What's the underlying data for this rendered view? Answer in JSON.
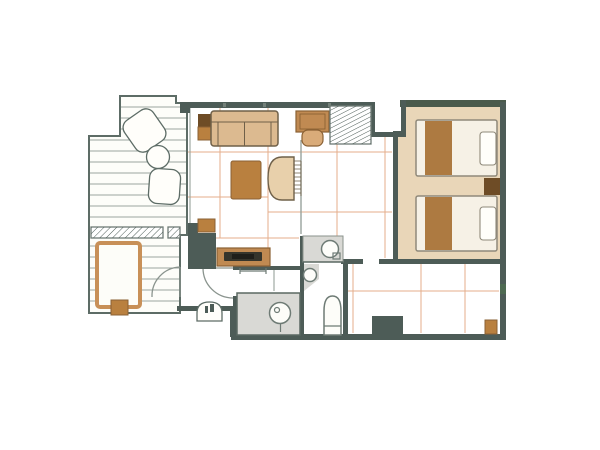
{
  "palette": {
    "wall": "#4d5c57",
    "wall_accent": "#4a5a4c",
    "outline": "#5d6c66",
    "fixture": "#6e7b75",
    "plank": "#9aa59f",
    "grid": "#dfa077",
    "floor_white": "#fdfdf9",
    "bedroom_floor": "#e9d6b8",
    "gray_floor": "#d9d9d5",
    "mattress": "#f6f1e6",
    "pillow": "#fffefa",
    "bed_runner": "#ad7a41",
    "bed_outline": "#8f897a",
    "wood_dark": "#6e4c26",
    "wood_medium": "#b9803f",
    "wood_light": "#d9ab79",
    "wood_line": "#8a6134",
    "sofa": "#dcba90",
    "lounge": "#e8d0ab",
    "desk_wood": "#c08a52",
    "furn_line": "#6f6049",
    "tub_rim": "#c89058",
    "door_arc": "#8a948e",
    "tatami_divider": "#98a29c",
    "shower_wall": "#5a6862",
    "door_mark": "#4e6a52",
    "tv_dark": "#35352c"
  },
  "rooms": [
    {
      "id": "terrace-deck"
    },
    {
      "id": "open-air-bath"
    },
    {
      "id": "living-room"
    },
    {
      "id": "bedroom"
    },
    {
      "id": "entrance-hall"
    },
    {
      "id": "washroom-anteroom"
    },
    {
      "id": "shower-room"
    },
    {
      "id": "washbasin-area"
    },
    {
      "id": "toilet-room"
    },
    {
      "id": "corridor"
    }
  ],
  "furniture": [
    {
      "id": "deck-chair-1"
    },
    {
      "id": "deck-chair-2"
    },
    {
      "id": "deck-round-table"
    },
    {
      "id": "deck-bench"
    },
    {
      "id": "bathtub"
    },
    {
      "id": "bathtub-step"
    },
    {
      "id": "sofa"
    },
    {
      "id": "sofa-side-table"
    },
    {
      "id": "coffee-table"
    },
    {
      "id": "lounge-chair"
    },
    {
      "id": "desk"
    },
    {
      "id": "desk-chair"
    },
    {
      "id": "luggage-rack"
    },
    {
      "id": "entrance-wardrobe"
    },
    {
      "id": "entrance-stool"
    },
    {
      "id": "tv-board"
    },
    {
      "id": "tv"
    },
    {
      "id": "bed-1"
    },
    {
      "id": "bed-2"
    },
    {
      "id": "nightstand"
    },
    {
      "id": "corridor-closet"
    },
    {
      "id": "corridor-stool"
    }
  ],
  "fixtures": [
    {
      "id": "washbasin"
    },
    {
      "id": "corner-basin"
    },
    {
      "id": "toilet"
    },
    {
      "id": "shower-stool"
    },
    {
      "id": "towel-bar"
    },
    {
      "id": "entrance-door"
    },
    {
      "id": "washroom-door"
    },
    {
      "id": "entrance-step"
    }
  ]
}
